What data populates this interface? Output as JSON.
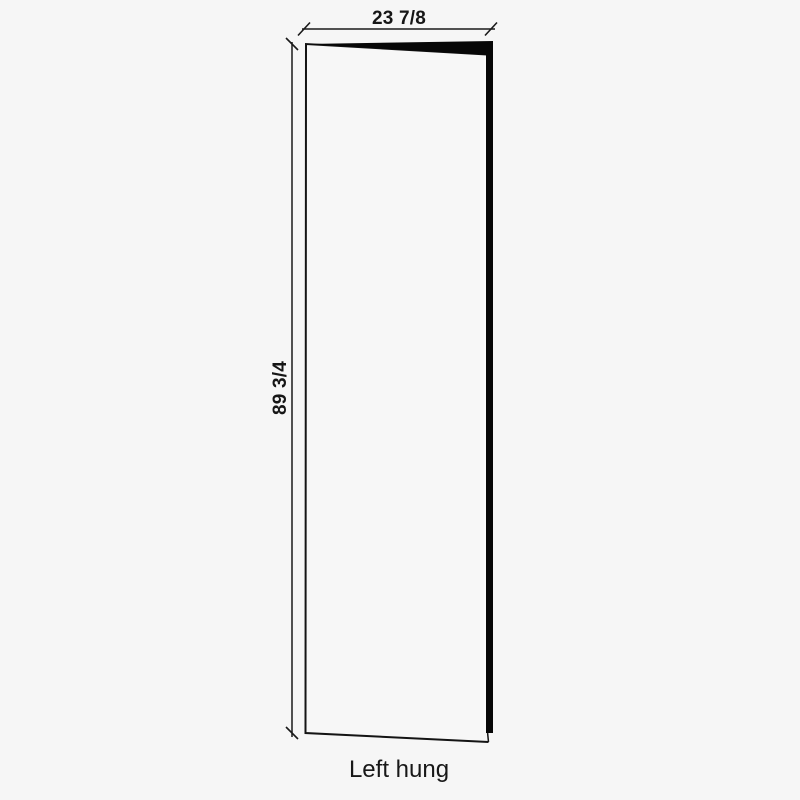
{
  "diagram": {
    "caption": "Left hung",
    "dimensions": {
      "width": {
        "label": "23 7/8"
      },
      "height": {
        "label": "89 3/4"
      }
    },
    "colors": {
      "background": "#f6f6f6",
      "line": "#1a1a1a",
      "door_face": "#f7f7f7",
      "door_edge": "#070707",
      "seam_highlight": "#fafafa",
      "text": "#1c1c1c"
    }
  }
}
